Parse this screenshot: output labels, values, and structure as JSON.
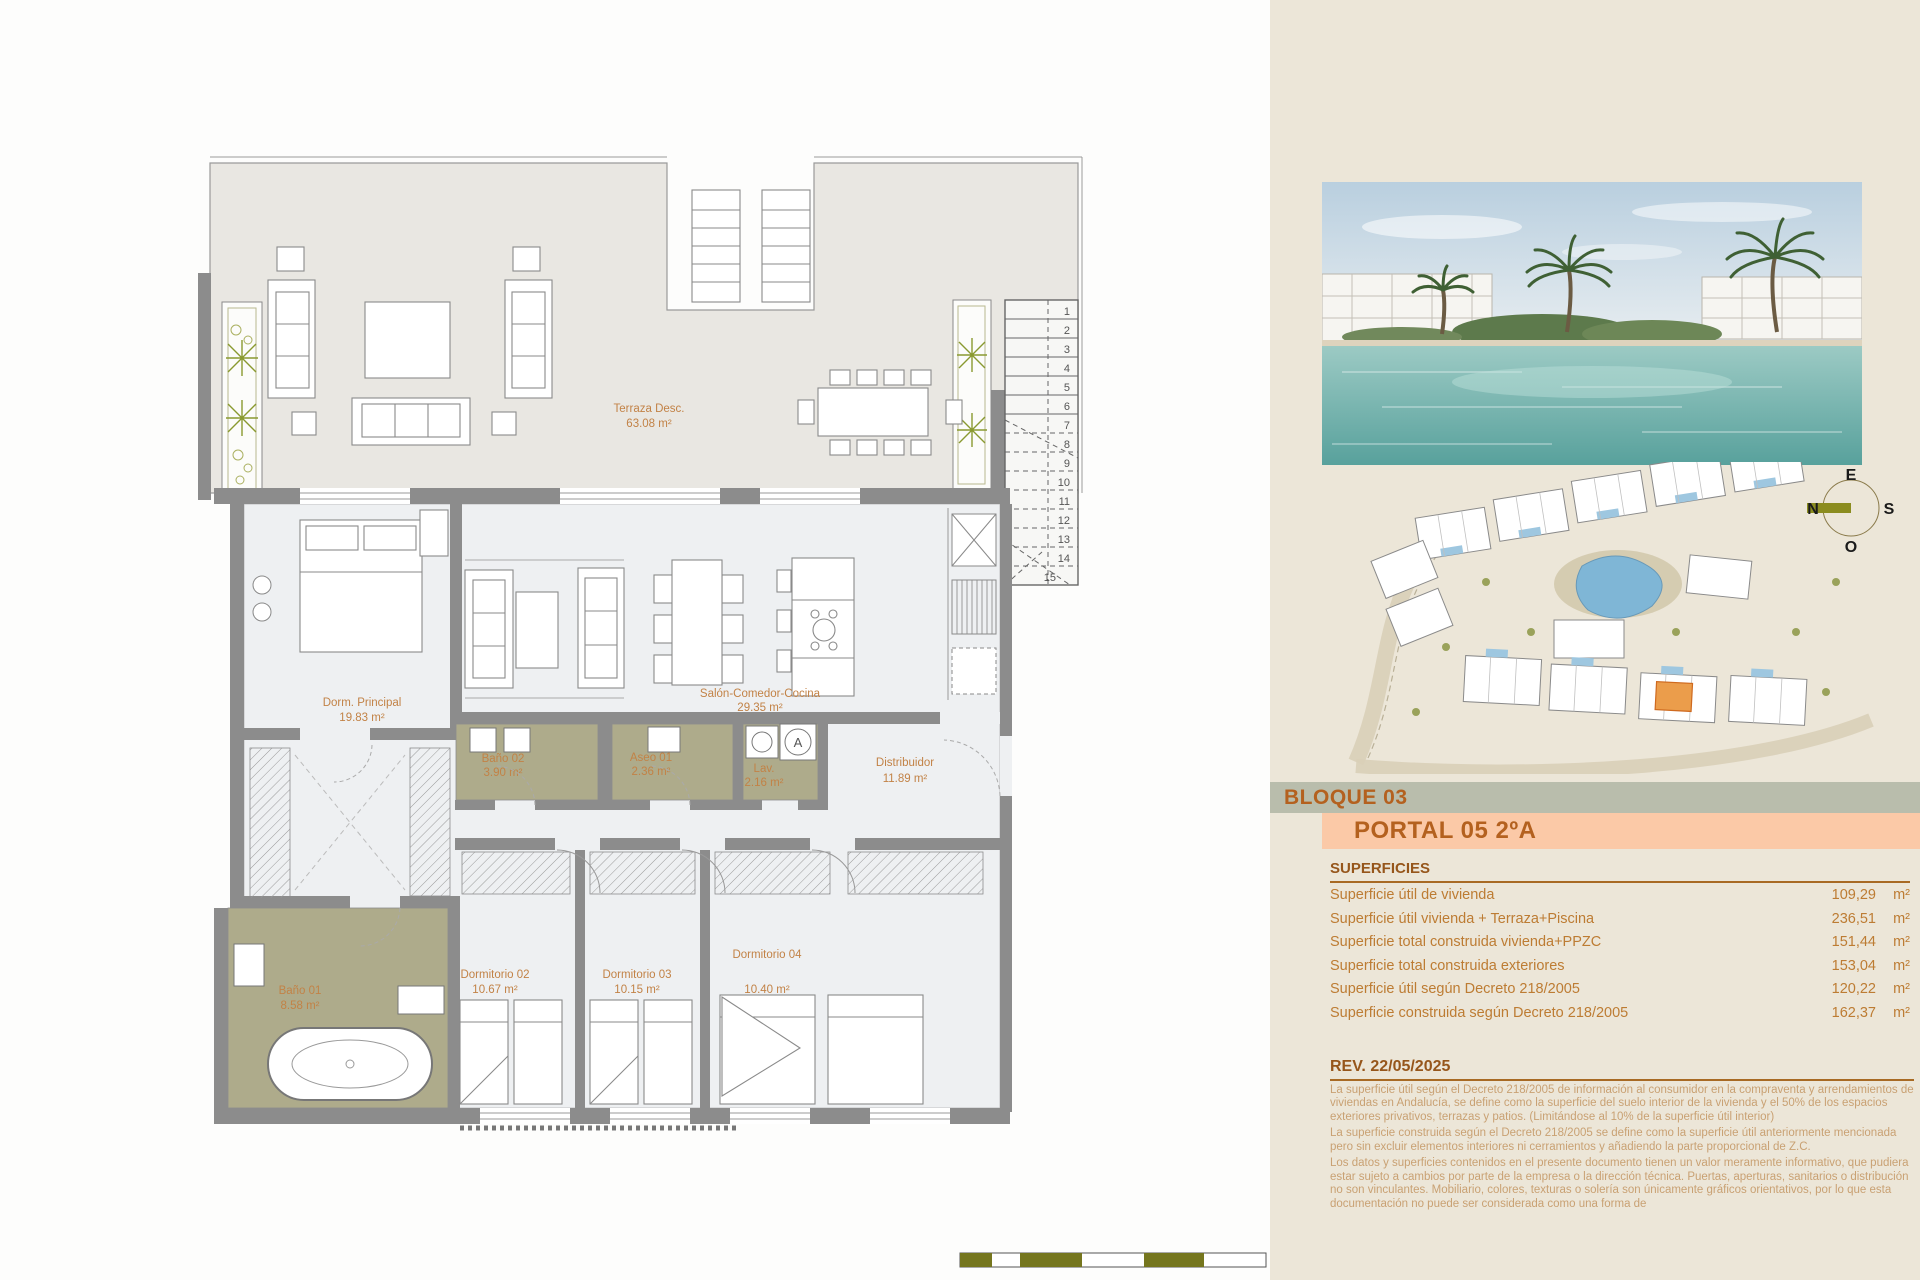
{
  "panel": {
    "bloque_label": "BLOQUE 03",
    "portal_label": "PORTAL 05 2ºA",
    "superficies": {
      "heading": "SUPERFICIES",
      "rows": [
        {
          "label": "Superficie útil de vivienda",
          "value": "109,29",
          "unit": "m²"
        },
        {
          "label": "Superficie útil vivienda + Terraza+Piscina",
          "value": "236,51",
          "unit": "m²"
        },
        {
          "label": "Superficie total construida vivienda+PPZC",
          "value": "151,44",
          "unit": "m²"
        },
        {
          "label": "Superficie total construida exteriores",
          "value": "153,04",
          "unit": "m²"
        },
        {
          "label": "Superficie útil según Decreto 218/2005",
          "value": "120,22",
          "unit": "m²"
        },
        {
          "label": "Superficie construida según Decreto 218/2005",
          "value": "162,37",
          "unit": "m²"
        }
      ]
    },
    "revision": {
      "heading": "REV. 22/05/2025",
      "paragraphs": [
        "La superficie útil según el Decreto 218/2005 de información al consumidor en la compraventa y arrendamientos de viviendas en Andalucía, se define como la superficie del suelo interior de la vivienda y el 50% de los espacios exteriores privativos, terrazas y patios. (Limitándose al 10% de la superficie útil interior)",
        "La superficie construida según el Decreto 218/2005 se define como la superficie útil anteriormente mencionada pero sin excluir elementos interiores ni cerramientos y añadiendo la parte proporcional de Z.C.",
        "Los datos y superficies contenidos en el presente documento tienen un valor meramente informativo, que pudiera estar sujeto a cambios por parte de la empresa o la dirección técnica. Puertas, aperturas, sanitarios o distribución no son vinculantes. Mobiliario, colores, texturas o solería son únicamente gráficos orientativos, por lo que esta documentación no puede ser considerada como una forma de"
      ]
    },
    "compass": {
      "east": "E",
      "south": "S",
      "west": "O",
      "north": "N"
    }
  },
  "floorplan": {
    "rooms": [
      {
        "name": "Terraza Desc.",
        "area": "63.08 m²"
      },
      {
        "name": "Dorm. Principal",
        "area": "19.83 m²"
      },
      {
        "name": "Salón-Comedor-Cocina",
        "area": "29.35 m²"
      },
      {
        "name": "Baño 02",
        "area": "3.90 m²"
      },
      {
        "name": "Aseo 01",
        "area": "2.36 m²"
      },
      {
        "name": "Lav.",
        "area": "2.16 m²"
      },
      {
        "name": "Distribuidor",
        "area": "11.89 m²"
      },
      {
        "name": "Dormitorio 02",
        "area": "10.67 m²"
      },
      {
        "name": "Dormitorio 03",
        "area": "10.15 m²"
      },
      {
        "name": "Dormitorio 04",
        "area": "10.40 m²"
      },
      {
        "name": "Baño 01",
        "area": "8.58 m²"
      }
    ],
    "washer_label": "A",
    "stair_numbers": [
      "1",
      "2",
      "3",
      "4",
      "5",
      "6",
      "7",
      "8",
      "9",
      "10",
      "11",
      "12",
      "13",
      "14",
      "15"
    ],
    "scale_ticks": [
      "0",
      "0.5",
      "1",
      "2",
      "3",
      "4",
      "5"
    ]
  },
  "colors": {
    "panel_bg": "#ECE6D8",
    "bloque_band": "#B9BDAC",
    "portal_band": "#FBC9A7",
    "heading_text": "#96561B",
    "accent_text": "#BD7C33",
    "body_text": "#C8A173",
    "wet_room": "#AEAB8B",
    "wall_gray": "#8C8C8C",
    "scale_olive": "#75761E",
    "plan_label": "#C28246",
    "pool_blue": "#7FB6D6"
  }
}
